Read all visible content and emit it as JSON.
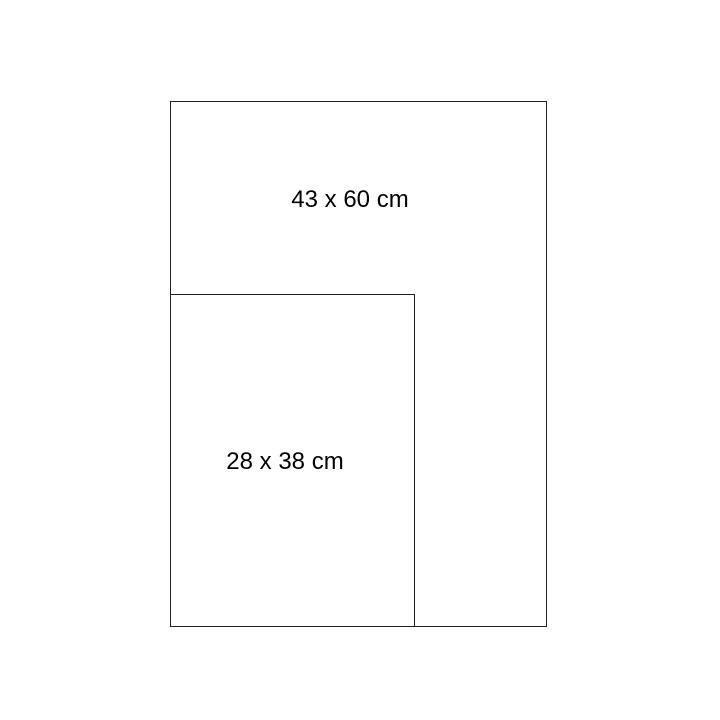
{
  "diagram": {
    "outer_rect": {
      "label": "43 x 60 cm"
    },
    "inner_rect": {
      "label": "28 x 38 cm"
    }
  },
  "colors": {
    "background": "#ffffff",
    "stroke": "#1f1f1f",
    "text": "#000000"
  }
}
